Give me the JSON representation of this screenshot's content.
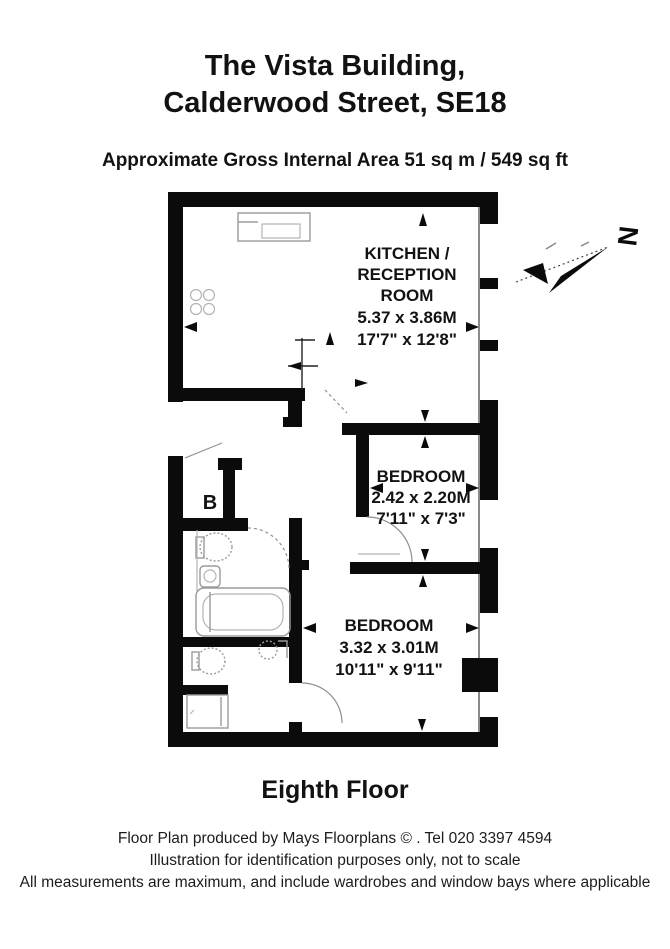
{
  "header": {
    "title_line1": "The Vista Building,",
    "title_line2": "Calderwood Street, SE18",
    "area_line": "Approximate Gross Internal Area 51 sq m /  549 sq ft"
  },
  "plan": {
    "kitchen": {
      "line1": "KITCHEN /",
      "line2": "RECEPTION",
      "line3": "ROOM",
      "metric": "5.37 x 3.86M",
      "imperial": "17'7\" x 12'8\""
    },
    "bedroom1": {
      "name": "BEDROOM",
      "metric": "2.42 x 2.20M",
      "imperial": "7'11\" x 7'3\""
    },
    "bedroom2": {
      "name": "BEDROOM",
      "metric": "3.32 x 3.01M",
      "imperial": "10'11\" x 9'11\""
    },
    "cupboard": {
      "label": "B"
    },
    "compass": {
      "north": "N"
    }
  },
  "floor_label": "Eighth Floor",
  "footer": {
    "line1": "Floor Plan produced by Mays Floorplans © . Tel 020 3397 4594",
    "line2": "Illustration for identification purposes only, not to scale",
    "line3": "All measurements are maximum, and include wardrobes and window bays where applicable"
  },
  "colors": {
    "wall": "#0b0b0b",
    "furniture": "#9b9b9b",
    "text": "#121212",
    "background": "#ffffff"
  }
}
